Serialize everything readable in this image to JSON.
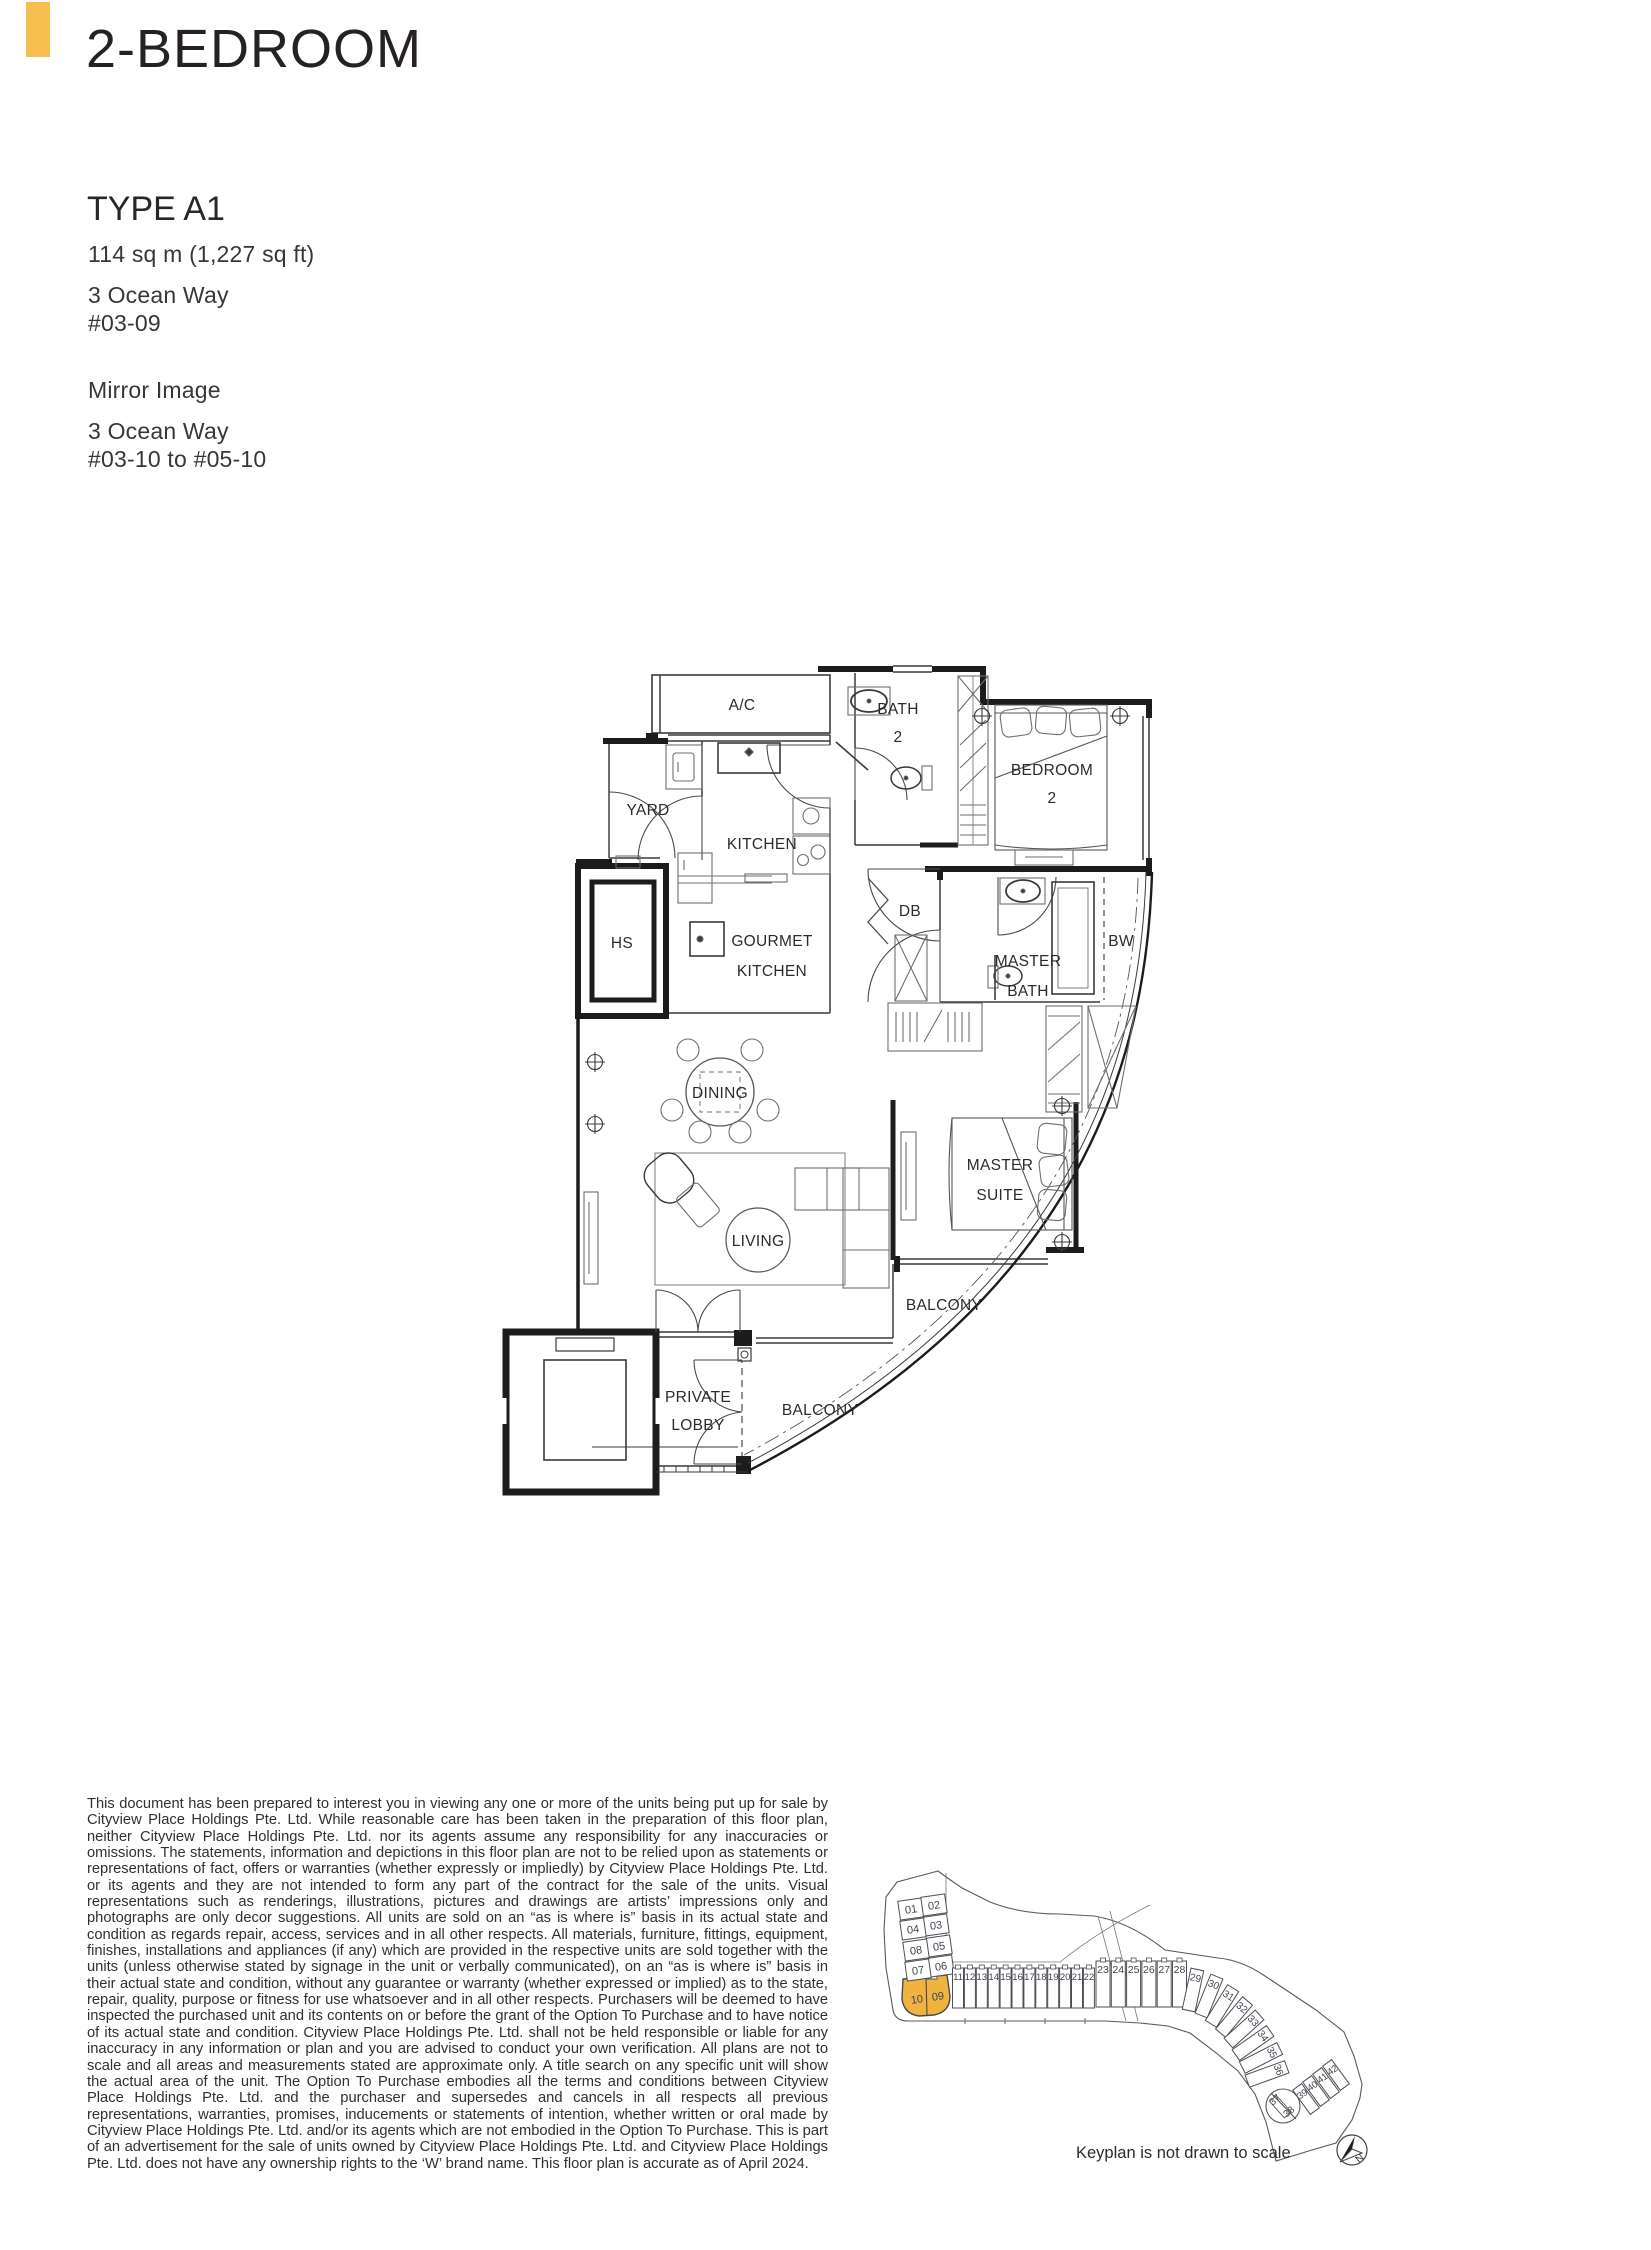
{
  "header": {
    "accent_color": "#F7C04E",
    "title": "2-BEDROOM"
  },
  "unit_info": {
    "type_label": "TYPE A1",
    "area": "114 sq m (1,227 sq ft)",
    "address": "3 Ocean Way",
    "unit_no": "#03-09",
    "mirror_label": "Mirror Image",
    "mirror_address": "3 Ocean Way",
    "mirror_unit_no": "#03-10 to #05-10"
  },
  "floor_plan": {
    "labels": {
      "ac": "A/C",
      "bath2_line1": "BATH",
      "bath2_line2": "2",
      "yard": "YARD",
      "kitchen": "KITCHEN",
      "hs": "HS",
      "gourmet_line1": "GOURMET",
      "gourmet_line2": "KITCHEN",
      "db": "DB",
      "bedroom2_line1": "BEDROOM",
      "bedroom2_line2": "2",
      "master_bath_line1": "MASTER",
      "master_bath_line2": "BATH",
      "bw": "BW",
      "dining": "DINING",
      "master_suite_line1": "MASTER",
      "master_suite_line2": "SUITE",
      "living": "LIVING",
      "balcony_right": "BALCONY",
      "balcony_bottom": "BALCONY",
      "private_lobby_line1": "PRIVATE",
      "private_lobby_line2": "LOBBY"
    }
  },
  "disclaimer": "This document has been prepared to interest you in viewing any one or more of the units being put up for sale by Cityview Place Holdings Pte. Ltd. While reasonable care has been taken in the preparation of this floor plan, neither Cityview Place Holdings Pte. Ltd. nor its agents assume any responsibility for any inaccuracies or omissions. The statements, information and depictions in this floor plan are not to be relied upon as statements or representations of fact, offers or warranties (whether expressly or impliedly) by Cityview Place Holdings Pte. Ltd. or its agents and they are not intended to form any part of the contract for the sale of the units. Visual representations such as renderings, illustrations, pictures and drawings are artists’ impressions only and photographs are only decor suggestions. All units are sold on an “as is where is” basis in its actual state and condition as regards repair, access, services and in all other respects. All materials, furniture, fittings, equipment, finishes, installations and appliances (if any) which are provided in the respective units are sold together with the units (unless otherwise stated by signage in the unit or verbally communicated), on an “as is where is” basis in their actual state and condition, without any guarantee or warranty (whether expressed or implied) as to the state, repair, quality, purpose or fitness for use whatsoever and in all other respects. Purchasers will be deemed to have inspected the purchased unit and its contents on or before the grant of the Option To Purchase and to have notice of its actual state and condition. Cityview Place Holdings Pte. Ltd. shall not be held responsible or liable for any inaccuracy in any information or plan and you are advised to conduct your own verification. All plans are not to scale and all areas and measurements stated are approximate only. A title search on any specific unit will show the actual area of the unit. The Option To Purchase embodies all the terms and conditions between Cityview Place Holdings Pte. Ltd. and the purchaser and supersedes and cancels in all respects all previous representations, warranties, promises, inducements or statements of intention, whether written or oral made by Cityview Place Holdings Pte. Ltd. and/or its agents which are not embodied in the Option To Purchase. This is part of an advertisement for the sale of units owned by Cityview Place Holdings Pte. Ltd. and Cityview Place Holdings Pte. Ltd. does not have any ownership rights to the ‘W’ brand name. This floor plan is accurate as of April 2024.",
  "keyplan": {
    "caption": "Keyplan is not drawn to scale",
    "highlight_color": "#F0B342",
    "highlighted_units": [
      "09",
      "10"
    ],
    "north_label": "N",
    "units": [
      "01",
      "02",
      "03",
      "04",
      "05",
      "06",
      "07",
      "08",
      "09",
      "10",
      "11",
      "12",
      "13",
      "14",
      "15",
      "16",
      "17",
      "18",
      "19",
      "20",
      "21",
      "22",
      "23",
      "24",
      "25",
      "26",
      "27",
      "28",
      "29",
      "30",
      "31",
      "32",
      "33",
      "34",
      "35",
      "36",
      "37",
      "38",
      "39",
      "40",
      "41",
      "42"
    ]
  }
}
